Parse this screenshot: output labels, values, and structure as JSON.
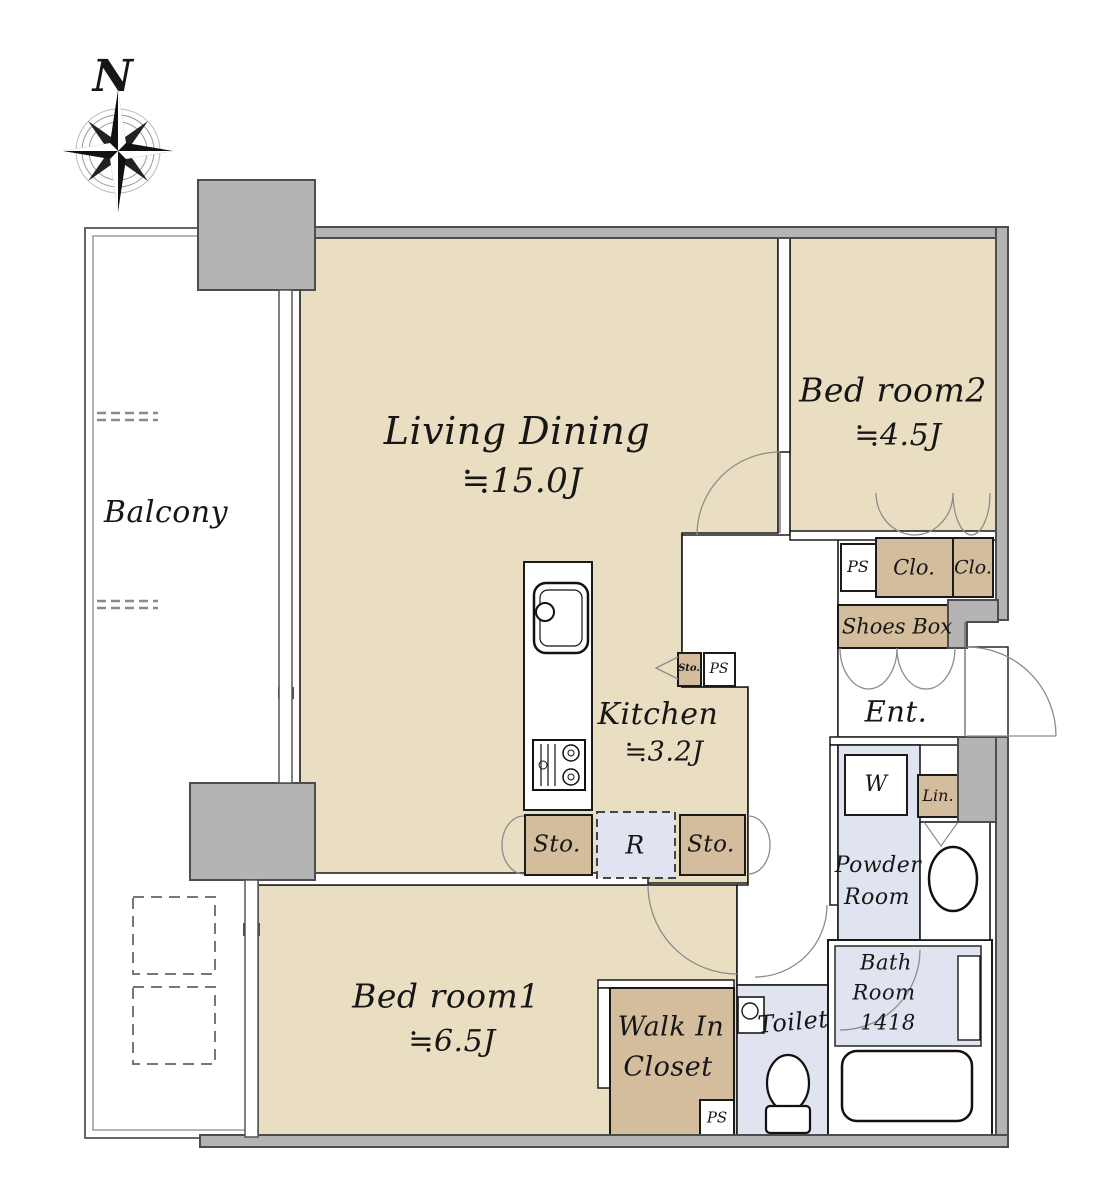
{
  "figure": {
    "type": "apartment-floor-plan",
    "compass_label": "N"
  },
  "rooms": {
    "balcony": {
      "name": "Balcony"
    },
    "living_dining": {
      "name": "Living Dining",
      "size": "≒15.0J"
    },
    "bedroom2": {
      "name": "Bed room2",
      "size": "≒4.5J"
    },
    "kitchen": {
      "name": "Kitchen",
      "size": "≒3.2J"
    },
    "bedroom1": {
      "name": "Bed room1",
      "size": "≒6.5J"
    },
    "walk_in_closet": {
      "name_line1": "Walk In",
      "name_line2": "Closet"
    },
    "toilet": {
      "name": "Toilet"
    },
    "powder_room": {
      "name_line1": "Powder",
      "name_line2": "Room"
    },
    "bath_room": {
      "name_line1": "Bath",
      "name_line2": "Room",
      "size": "1418"
    },
    "entrance": {
      "name": "Ent."
    }
  },
  "fixtures": {
    "shoes_box": "Shoes Box",
    "closet_abbr": "Clo.",
    "linen_abbr": "Lin.",
    "pipe_space_abbr": "PS",
    "storage_abbr": "Sto.",
    "refrigerator_abbr": "R",
    "washer_abbr": "W"
  },
  "colors": {
    "room_floor": "#e9dec1",
    "storage_floor": "#d3bd9d",
    "wet_area_floor": "#e0e4f0",
    "wall_fill": "#b4b4b4",
    "wall_edge": "#4d4d4d",
    "line": "#1a1a1a",
    "door_arc": "#8c8c8c"
  }
}
